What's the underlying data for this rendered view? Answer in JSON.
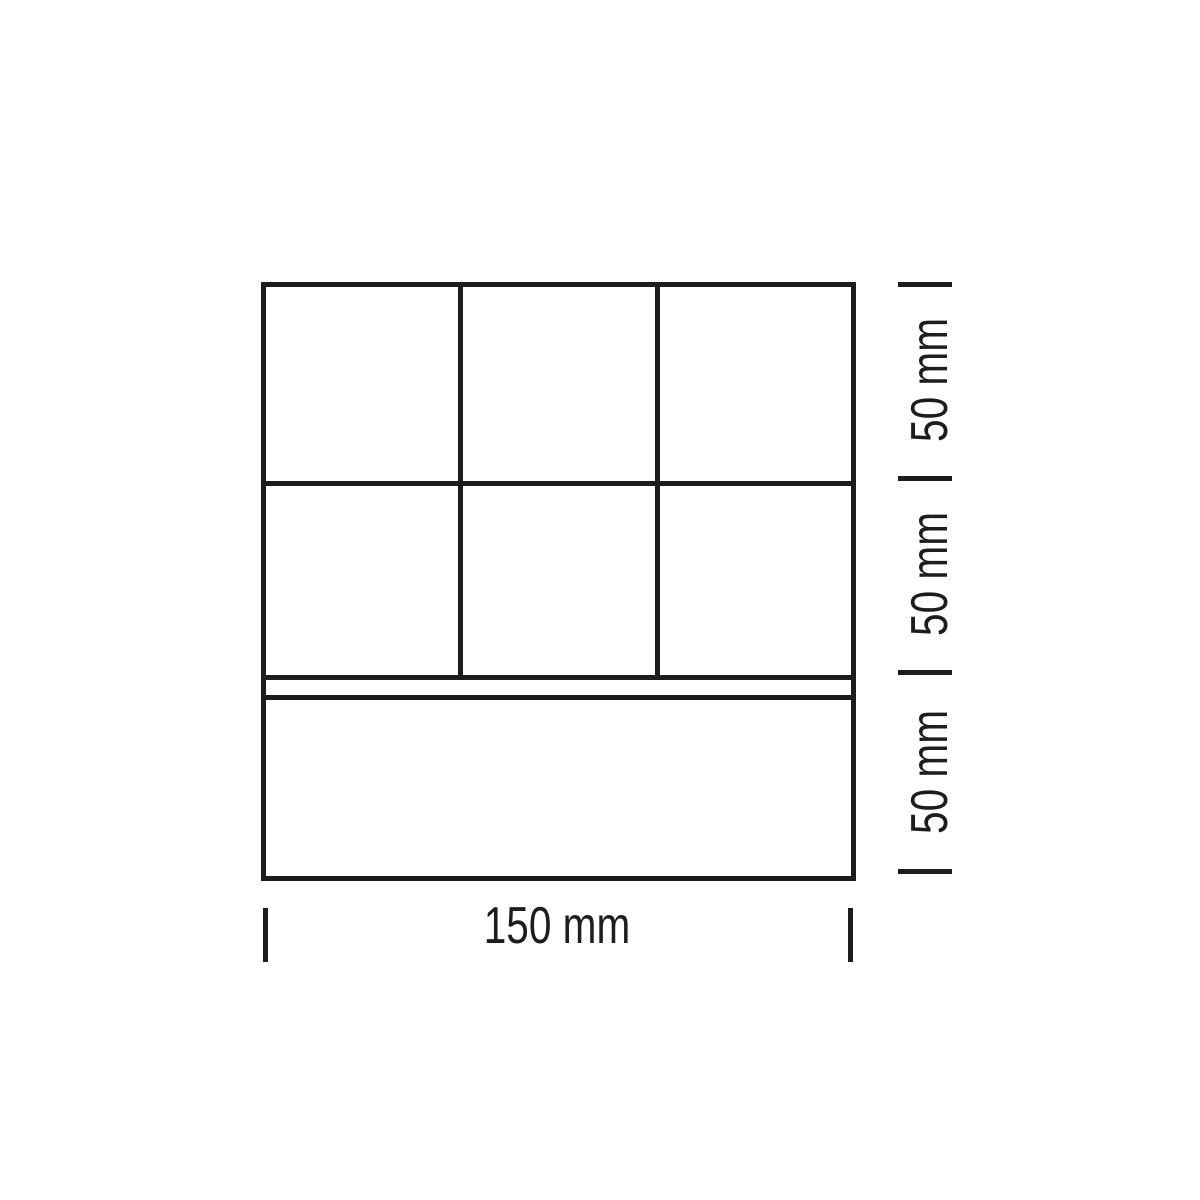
{
  "drawing": {
    "type": "technical-dimension-drawing",
    "background_color": "#ffffff",
    "line_color": "#1d1d1b",
    "panel": {
      "width_mm": 150,
      "height_mm": 150,
      "rows": 3,
      "top_row_columns": 3,
      "structure": "two rows of three square cells above a thin horizontal rail strip and one full-width bottom panel"
    }
  },
  "dimensions": {
    "bottom_width": {
      "label": "150 mm",
      "value_mm": 150
    },
    "right_segments": [
      {
        "label": "50 mm",
        "value_mm": 50
      },
      {
        "label": "50 mm",
        "value_mm": 50
      },
      {
        "label": "50 mm",
        "value_mm": 50
      }
    ]
  }
}
